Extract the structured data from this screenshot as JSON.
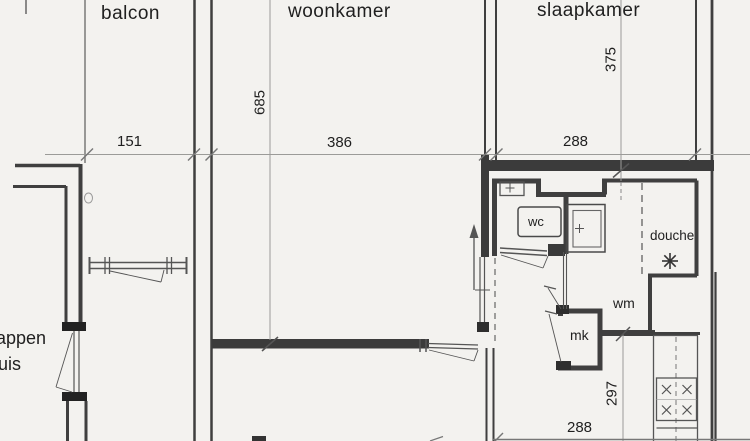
{
  "rooms": {
    "balcon": {
      "label": "balcon"
    },
    "woonkamer": {
      "label": "woonkamer"
    },
    "slaapkamer": {
      "label": "slaapkamer"
    },
    "wc": {
      "label": "wc"
    },
    "douche": {
      "label": "douche"
    },
    "wm": {
      "label": "wm"
    },
    "mk": {
      "label": "mk"
    },
    "stairwell": {
      "label_line1": "appen",
      "label_line2": "uis"
    }
  },
  "dimensions_cm": {
    "balcon_width": "151",
    "woonkamer_width": "386",
    "slaapkamer_width": "288",
    "woonkamer_depth": "685",
    "slaapkamer_depth": "375",
    "kitchen_hall_depth": "297",
    "bottom_section_width": "288"
  },
  "icons": {
    "shower_symbol": "asterisk-star",
    "entrance_arrow": "up-arrow",
    "stove_burner": "x-cross"
  },
  "colors": {
    "background": "#f3f2ef",
    "wall": "#3b3b3b",
    "dimension_line": "#9b9b98",
    "text": "#1f1f1f"
  }
}
